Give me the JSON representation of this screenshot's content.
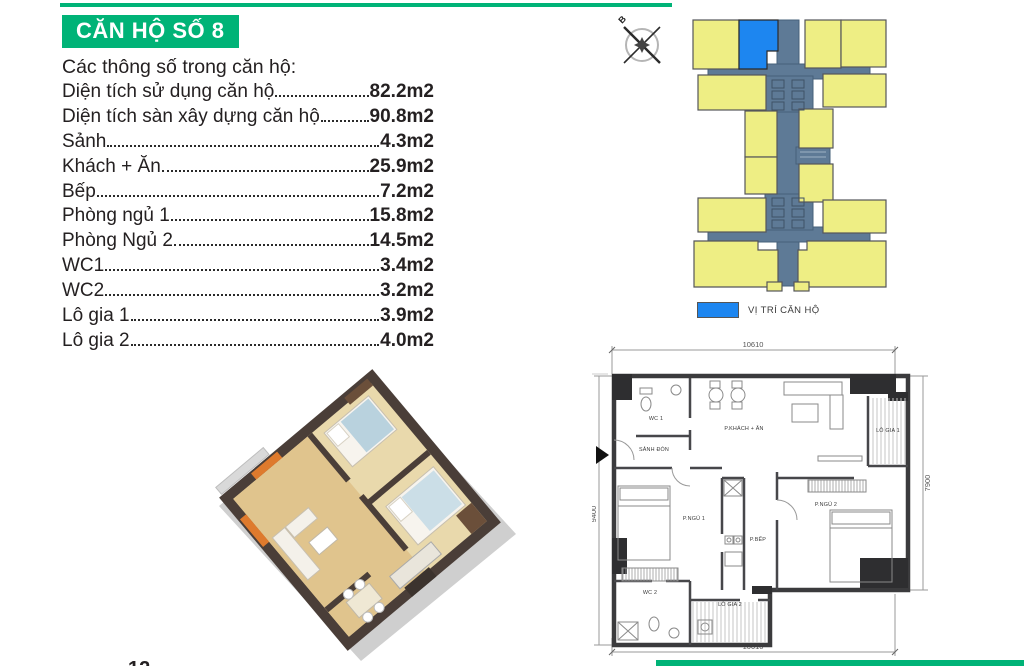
{
  "title": "CĂN HỘ SỐ 8",
  "page": {
    "number": "12"
  },
  "theme": {
    "green": "#00B377",
    "highlight_blue": "#1D86F0",
    "unit_yellow": "#EEEE84",
    "corridor_slate": "#5E7A96",
    "text_dark": "#242021"
  },
  "specs": {
    "header": "Các thông số trong căn hộ:",
    "items": [
      {
        "label": "Diện tích sử dụng căn hộ",
        "value": "82.2m2"
      },
      {
        "label": "Diện tích sàn xây dựng căn hộ",
        "value": "90.8m2"
      },
      {
        "label": "Sảnh",
        "value": "4.3m2"
      },
      {
        "label": "Khách + Ăn",
        "value": "25.9m2"
      },
      {
        "label": "Bếp",
        "value": "7.2m2"
      },
      {
        "label": "Phòng ngủ 1",
        "value": "15.8m2"
      },
      {
        "label": "Phòng Ngủ 2",
        "value": "14.5m2"
      },
      {
        "label": "WC1",
        "value": "3.4m2"
      },
      {
        "label": "WC2",
        "value": "3.2m2"
      },
      {
        "label": "Lô gia 1",
        "value": "3.9m2"
      },
      {
        "label": "Lô gia 2",
        "value": "4.0m2"
      }
    ]
  },
  "site_plan": {
    "compass_label": "B",
    "legend_label": "VỊ TRÍ CĂN HỘ"
  },
  "floor_plan": {
    "dimensions": {
      "top": "10610",
      "bottom": "10610",
      "left": "9400",
      "right": "7900"
    },
    "rooms": [
      {
        "name": "WC 1"
      },
      {
        "name": "SẢNH ĐÓN"
      },
      {
        "name": "P.KHÁCH + ĂN"
      },
      {
        "name": "LÔ GIA 1"
      },
      {
        "name": "P.NGỦ 1"
      },
      {
        "name": "P.BẾP"
      },
      {
        "name": "P.NGỦ 2"
      },
      {
        "name": "WC 2"
      },
      {
        "name": "LÔ GIA 2"
      }
    ]
  }
}
